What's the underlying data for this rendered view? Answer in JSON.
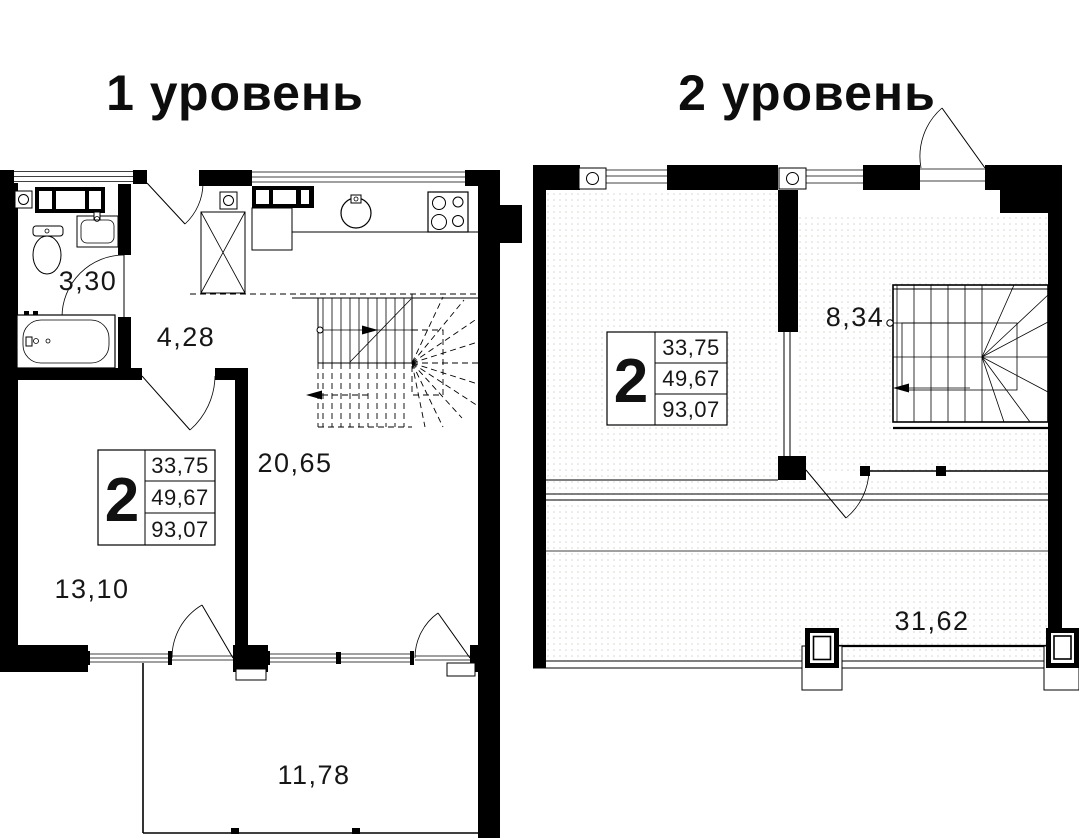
{
  "page": {
    "background": "#ffffff",
    "ink": "#000000",
    "floor_dot_color": "#d9d4ce"
  },
  "level1": {
    "title": "1 уровень",
    "unit_box": {
      "room_count": "2",
      "area_rows": [
        "33,75",
        "49,67",
        "93,07"
      ]
    },
    "room_areas": {
      "bathroom": "3,30",
      "hall": "4,28",
      "living_kitchen": "20,65",
      "bedroom": "13,10",
      "balcony": "11,78"
    }
  },
  "level2": {
    "title": "2 уровень",
    "unit_box": {
      "room_count": "2",
      "area_rows": [
        "33,75",
        "49,67",
        "93,07"
      ]
    },
    "room_areas": {
      "stair_hall": "8,34",
      "terrace": "31,62"
    }
  }
}
